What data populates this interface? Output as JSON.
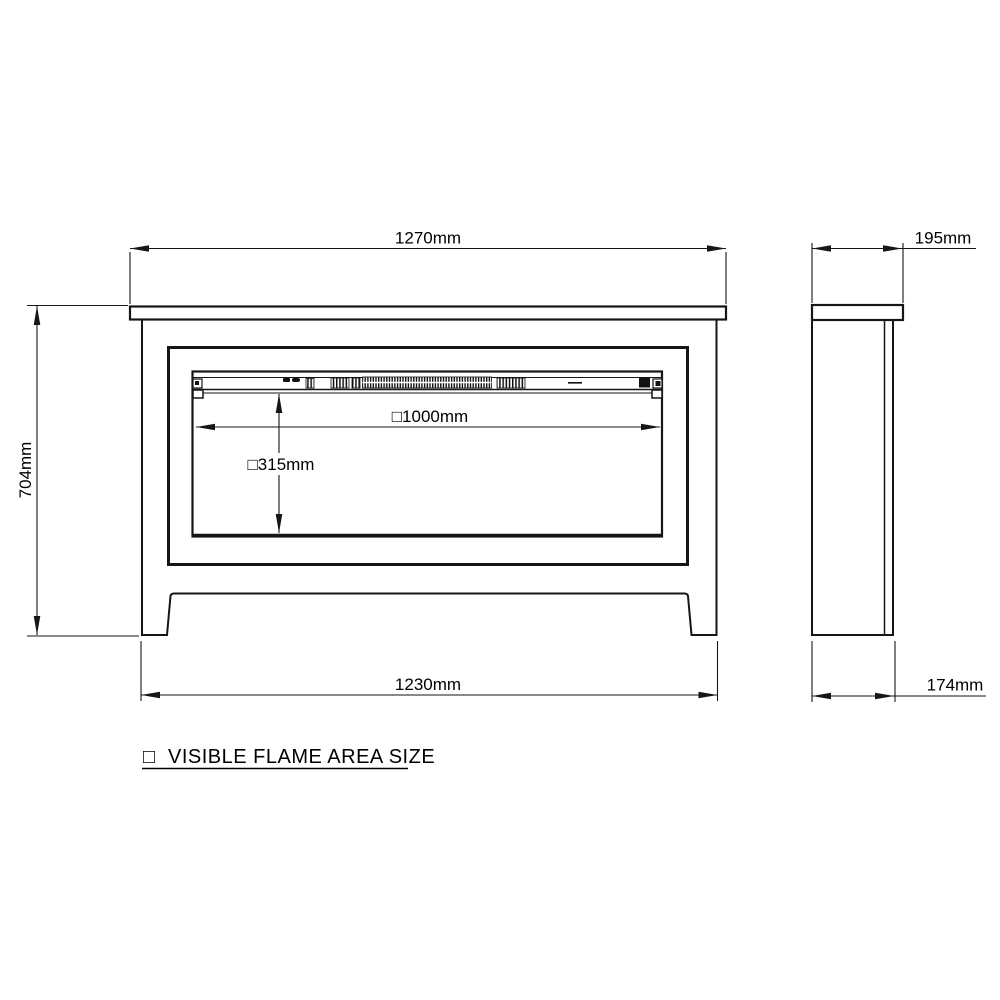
{
  "drawing": {
    "type": "dimension-drawing",
    "subject": "fireplace suite front and side elevations",
    "colors": {
      "background": "#ffffff",
      "line": "#161616",
      "text": "#000000"
    }
  },
  "front_view": {
    "dim_top_width": "1270mm",
    "dim_height": "704mm",
    "dim_base_width": "1230mm",
    "dim_flame_width": "□1000mm",
    "dim_flame_height": "□315mm"
  },
  "side_view": {
    "dim_top_depth": "195mm",
    "dim_base_depth": "174mm"
  },
  "legend": {
    "symbol": "□",
    "label": "VISIBLE FLAME AREA SIZE"
  }
}
